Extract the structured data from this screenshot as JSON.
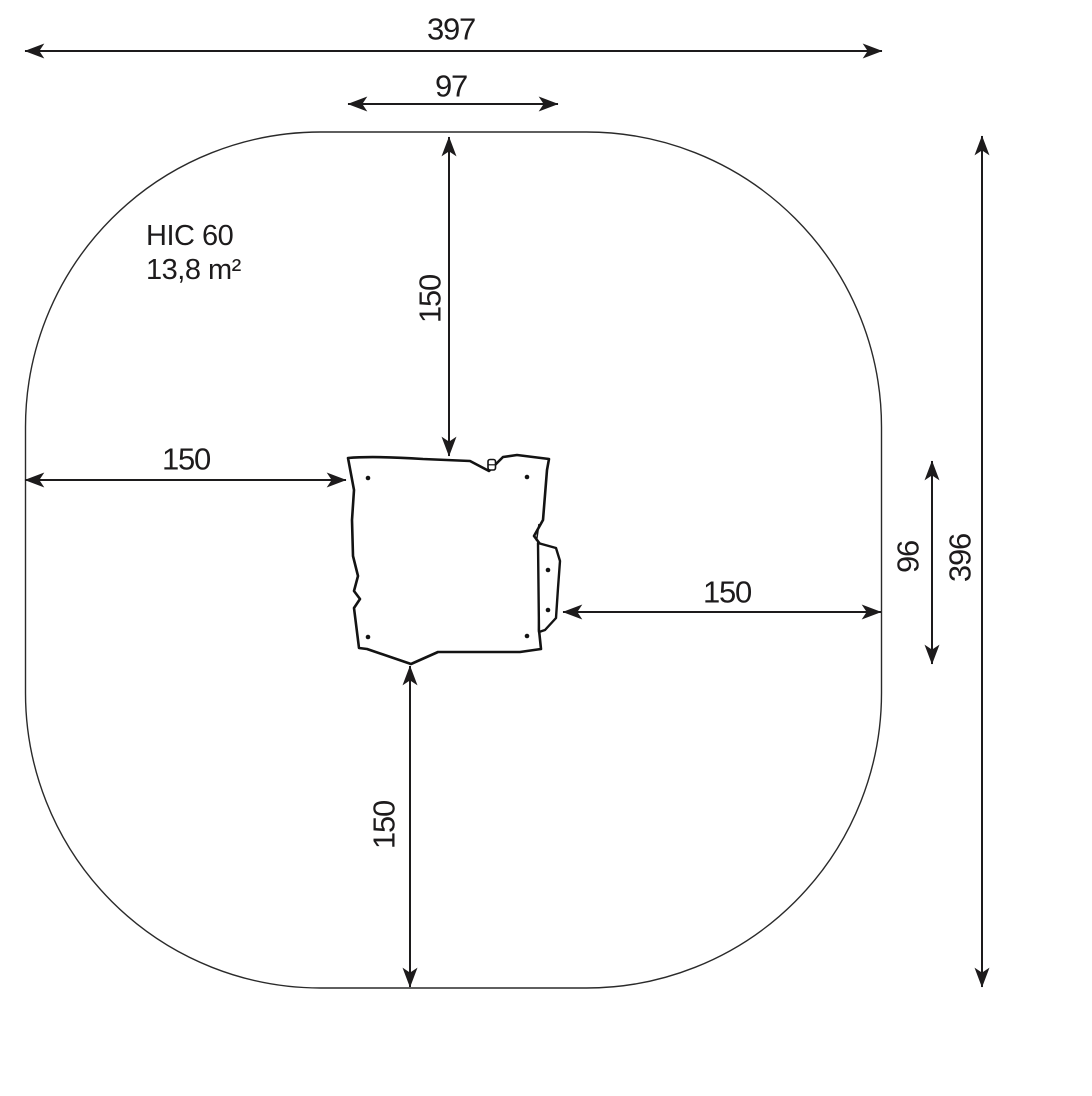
{
  "diagram": {
    "kind": "playground-equipment-safety-zone-plan",
    "area_label": {
      "line1": "HIC 60",
      "line2": "13,8 m²"
    },
    "dimensions": {
      "total_width": "397",
      "equipment_width": "97",
      "total_height": "396",
      "equipment_height": "96",
      "clearance_top": "150",
      "clearance_left": "150",
      "clearance_right": "150",
      "clearance_bottom": "150"
    },
    "colors": {
      "line": "#1d1b1c",
      "background": "#ffffff"
    }
  }
}
